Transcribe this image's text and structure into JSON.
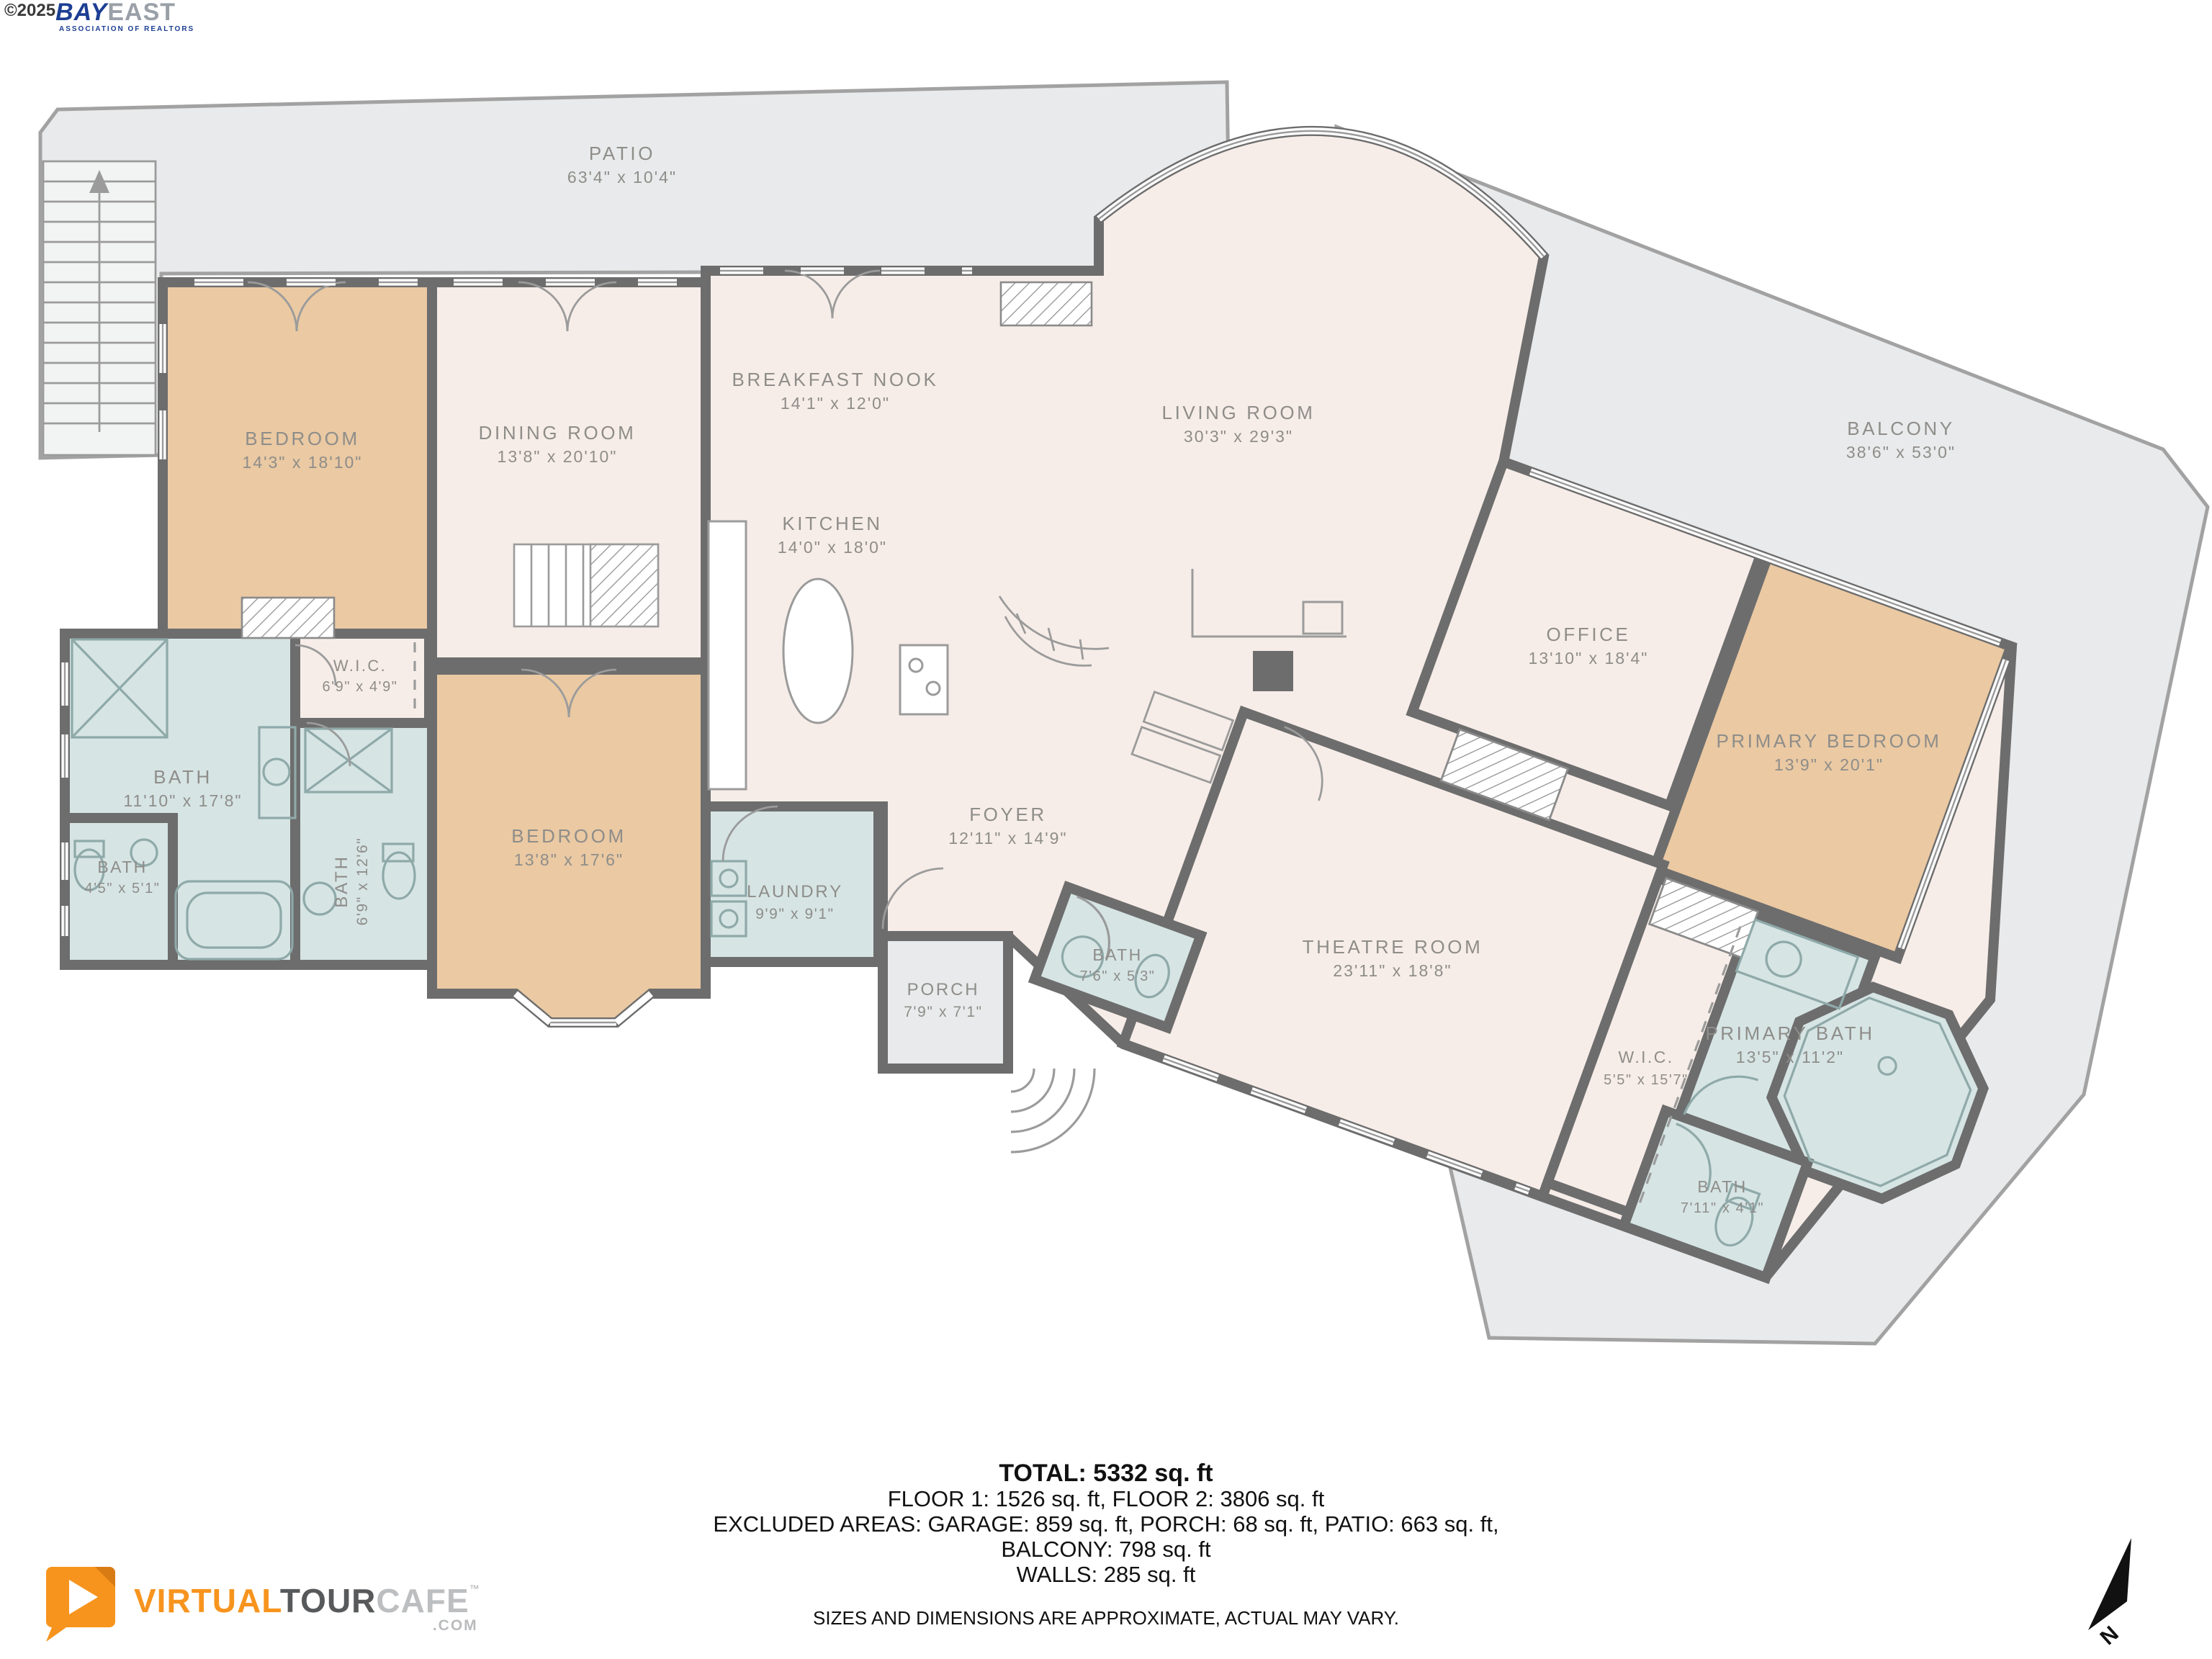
{
  "branding": {
    "bayeast": {
      "copyright": "©2025",
      "bay": "BAY",
      "east": "EAST",
      "tagline": "ASSOCIATION OF REALTORS"
    },
    "virtualtourcafe": {
      "part1": "VIRTUAL",
      "part2": "TOUR",
      "part3": "CAFE",
      "tm": "™",
      "domain": ".COM"
    }
  },
  "compass": {
    "label": "N"
  },
  "colors": {
    "walls": "#6d6d6d",
    "room_cream": "#f7ede8",
    "room_tan": "#eac9a3",
    "room_bath_blue": "#d6e4e4",
    "outdoor_gray": "#e9eaeb",
    "label_gray": "#8e8d89",
    "logo_orange": "#f7941e",
    "bayeast_blue": "#1c3e93"
  },
  "rooms": [
    {
      "id": "patio",
      "name": "PATIO",
      "dims": "63'4\" x 10'4\""
    },
    {
      "id": "bedroom-left",
      "name": "BEDROOM",
      "dims": "14'3\" x 18'10\""
    },
    {
      "id": "dining-room",
      "name": "DINING ROOM",
      "dims": "13'8\" x 20'10\""
    },
    {
      "id": "breakfast-nook",
      "name": "BREAKFAST NOOK",
      "dims": "14'1\" x 12'0\""
    },
    {
      "id": "kitchen",
      "name": "KITCHEN",
      "dims": "14'0\" x 18'0\""
    },
    {
      "id": "living-room",
      "name": "LIVING ROOM",
      "dims": "30'3\" x 29'3\""
    },
    {
      "id": "balcony",
      "name": "BALCONY",
      "dims": "38'6\" x 53'0\""
    },
    {
      "id": "office",
      "name": "OFFICE",
      "dims": "13'10\" x 18'4\""
    },
    {
      "id": "primary-bedroom",
      "name": "PRIMARY BEDROOM",
      "dims": "13'9\" x 20'1\""
    },
    {
      "id": "bath-main",
      "name": "BATH",
      "dims": "11'10\" x 17'8\""
    },
    {
      "id": "wic-left",
      "name": "W.I.C.",
      "dims": "6'9\" x 4'9\""
    },
    {
      "id": "bath-small-left",
      "name": "BATH",
      "dims": "4'5\" x 5'1\""
    },
    {
      "id": "bath-vertical",
      "name": "BATH",
      "dims": "6'9\" x 12'6\""
    },
    {
      "id": "bedroom-lower",
      "name": "BEDROOM",
      "dims": "13'8\" x 17'6\""
    },
    {
      "id": "laundry",
      "name": "LAUNDRY",
      "dims": "9'9\" x 9'1\""
    },
    {
      "id": "foyer",
      "name": "FOYER",
      "dims": "12'11\" x 14'9\""
    },
    {
      "id": "porch",
      "name": "PORCH",
      "dims": "7'9\" x 7'1\""
    },
    {
      "id": "bath-foyer",
      "name": "BATH",
      "dims": "7'6\" x 5'3\""
    },
    {
      "id": "theatre-room",
      "name": "THEATRE ROOM",
      "dims": "23'11\" x 18'8\""
    },
    {
      "id": "wic-primary",
      "name": "W.I.C.",
      "dims": "5'5\" x 15'7\""
    },
    {
      "id": "primary-bath",
      "name": "PRIMARY BATH",
      "dims": "13'5\" x 11'2\""
    },
    {
      "id": "bath-primary",
      "name": "BATH",
      "dims": "7'11\" x 4'1\""
    }
  ],
  "footer": {
    "total": "TOTAL: 5332 sq. ft",
    "floors": "FLOOR 1: 1526 sq. ft, FLOOR 2: 3806 sq. ft",
    "excluded": "EXCLUDED AREAS: GARAGE: 859 sq. ft, PORCH: 68 sq. ft, PATIO: 663 sq. ft,",
    "balcony": "BALCONY: 798 sq. ft",
    "walls": "WALLS: 285 sq. ft",
    "disclaimer": "SIZES AND DIMENSIONS ARE APPROXIMATE, ACTUAL MAY VARY."
  }
}
